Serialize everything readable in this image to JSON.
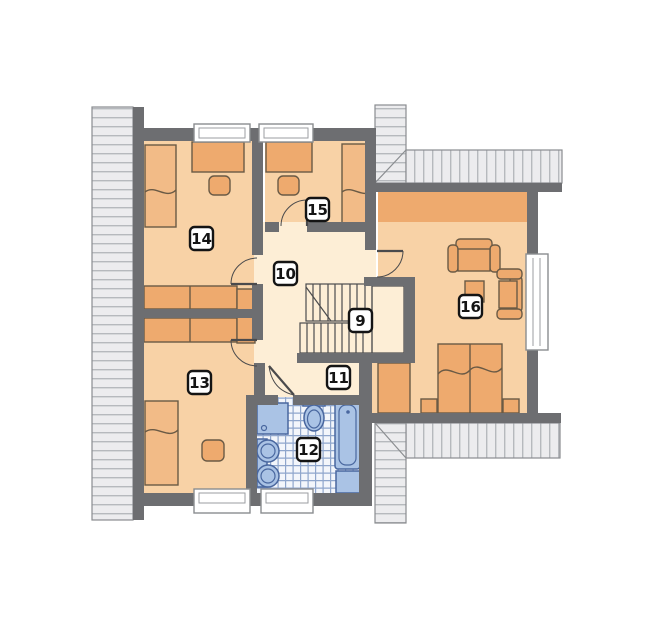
{
  "title": "attic-floor-plan",
  "labels": [
    {
      "key": "staircase",
      "number": "9"
    },
    {
      "key": "hall",
      "number": "10"
    },
    {
      "key": "corridor",
      "number": "11"
    },
    {
      "key": "bathroom",
      "number": "12"
    },
    {
      "key": "bedroom-left",
      "number": "13"
    },
    {
      "key": "bedroom-top-left",
      "number": "14"
    },
    {
      "key": "bedroom-top",
      "number": "15"
    },
    {
      "key": "master-bedroom",
      "number": "16"
    }
  ],
  "colors": {
    "wall": "#6d6e71",
    "room_fill": "#f8d2a6",
    "hall_fill": "#fdeed6",
    "furniture_fill": "#eeaa6e",
    "bed_fill": "#f2bb87",
    "furniture_outline": "#6a5a45",
    "fixture_fill": "#aac3e5",
    "fixture_stroke": "#49679f",
    "tile_line": "#8fa6cc",
    "hatch_bg": "#ececee",
    "hatch_line": "#b6b9bd",
    "hatch_border": "#8a8d90",
    "label_border": "#141414"
  }
}
